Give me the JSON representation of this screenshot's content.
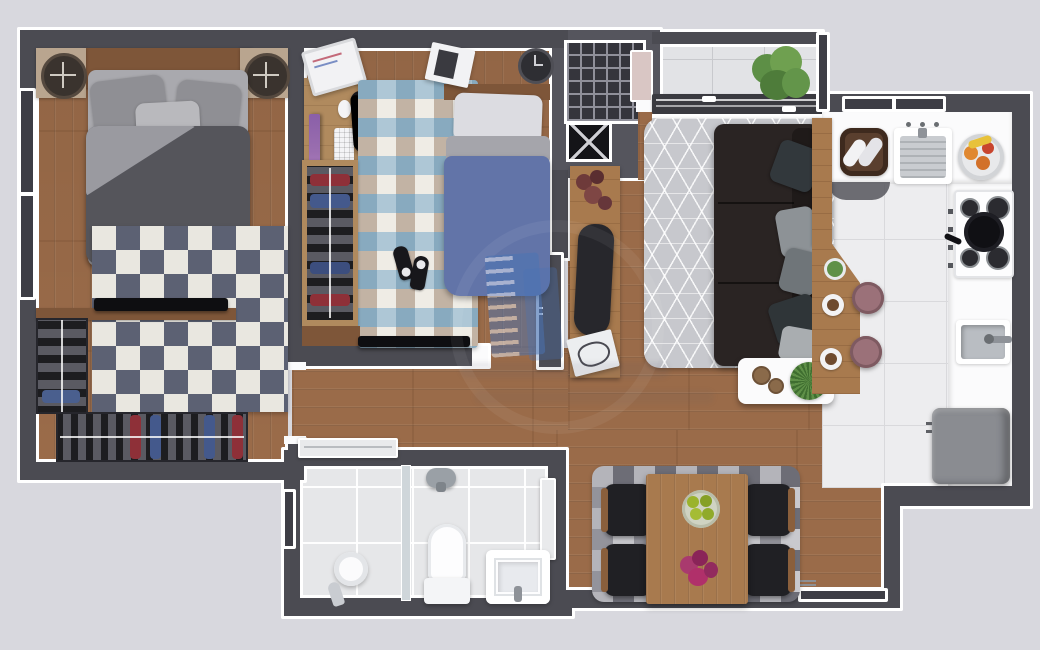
{
  "meta": {
    "title": "Apartment floor plan — top-down furnished render",
    "text_visible": "none (illegible watermark only)"
  },
  "palette": {
    "bg": "#d8d8de",
    "wall": "#4b4b52",
    "slab": "#55555d",
    "trim": "#ffffff",
    "wood": "#9a6b49",
    "wood_dark": "#7e5639",
    "tile_kitchen": "#ededef",
    "tile_bath": "#e6e7e9",
    "tile_balcony": "#e2e3e6",
    "rug1_dark": "#5c6173",
    "rug1_light": "#e9e7e0",
    "rug2_blue": "#aec7d6",
    "rug2_cream": "#efece5",
    "rug2_tan": "#c2b3a4",
    "rug2_steel": "#88aabf",
    "rug_living": "#c7c8cd",
    "rugd_a": "#6d6d76",
    "rugd_b": "#c9c9ce",
    "rugd_c": "#93939b",
    "rugd_d": "#b4b4ba",
    "sofa": "#2a2423",
    "sofa_back": "#1f1a19",
    "duvet_bed1": "#55555b",
    "pillow_gray": "#8f8f94",
    "pillow_light": "#b9b9bd",
    "duvet_bed2": "#6274a8",
    "pillow_white": "#dcdce1",
    "table_wood": "#a87a4e",
    "chair_black": "#202024",
    "stool_pink": "#9b7179",
    "fridge_gray": "#8a8c91",
    "plant_green": "#5f9048",
    "flower_magenta": "#a93a6e",
    "monitor_purple": "#9b6fb0",
    "watermark_blue": "#4a74b4"
  },
  "watermark": {
    "icon": "building-icon",
    "color": "#4a74b4",
    "legible_text": ""
  },
  "rooms": [
    {
      "id": "bedroom-1",
      "label": "Bedroom 1 (double bed, nightstands, rug, TV, L-shaped closet)"
    },
    {
      "id": "bedroom-2",
      "label": "Bedroom 2 (single bed, desk, chair, wardrobe, rug, TV)"
    },
    {
      "id": "hallway",
      "label": "Hallway"
    },
    {
      "id": "living-room",
      "label": "Living room (sofa, rug, coffee table, console)"
    },
    {
      "id": "kitchen",
      "label": "Kitchen (counter, sink, stove, fridge, breakfast bar, 2 stools)"
    },
    {
      "id": "balcony",
      "label": "Balcony (plant, sliding door)"
    },
    {
      "id": "bathroom",
      "label": "Bathroom (shower, toilet, sink)"
    },
    {
      "id": "dining-room",
      "label": "Dining room (table, 4 chairs, rug)"
    },
    {
      "id": "stairwell",
      "label": "Common stairwell (stairs, shaft, doormat)"
    }
  ],
  "counts": {
    "bedrooms": 2,
    "bathrooms": 1,
    "stools": 2,
    "dining_chairs": 4,
    "stove_burners": 4
  }
}
